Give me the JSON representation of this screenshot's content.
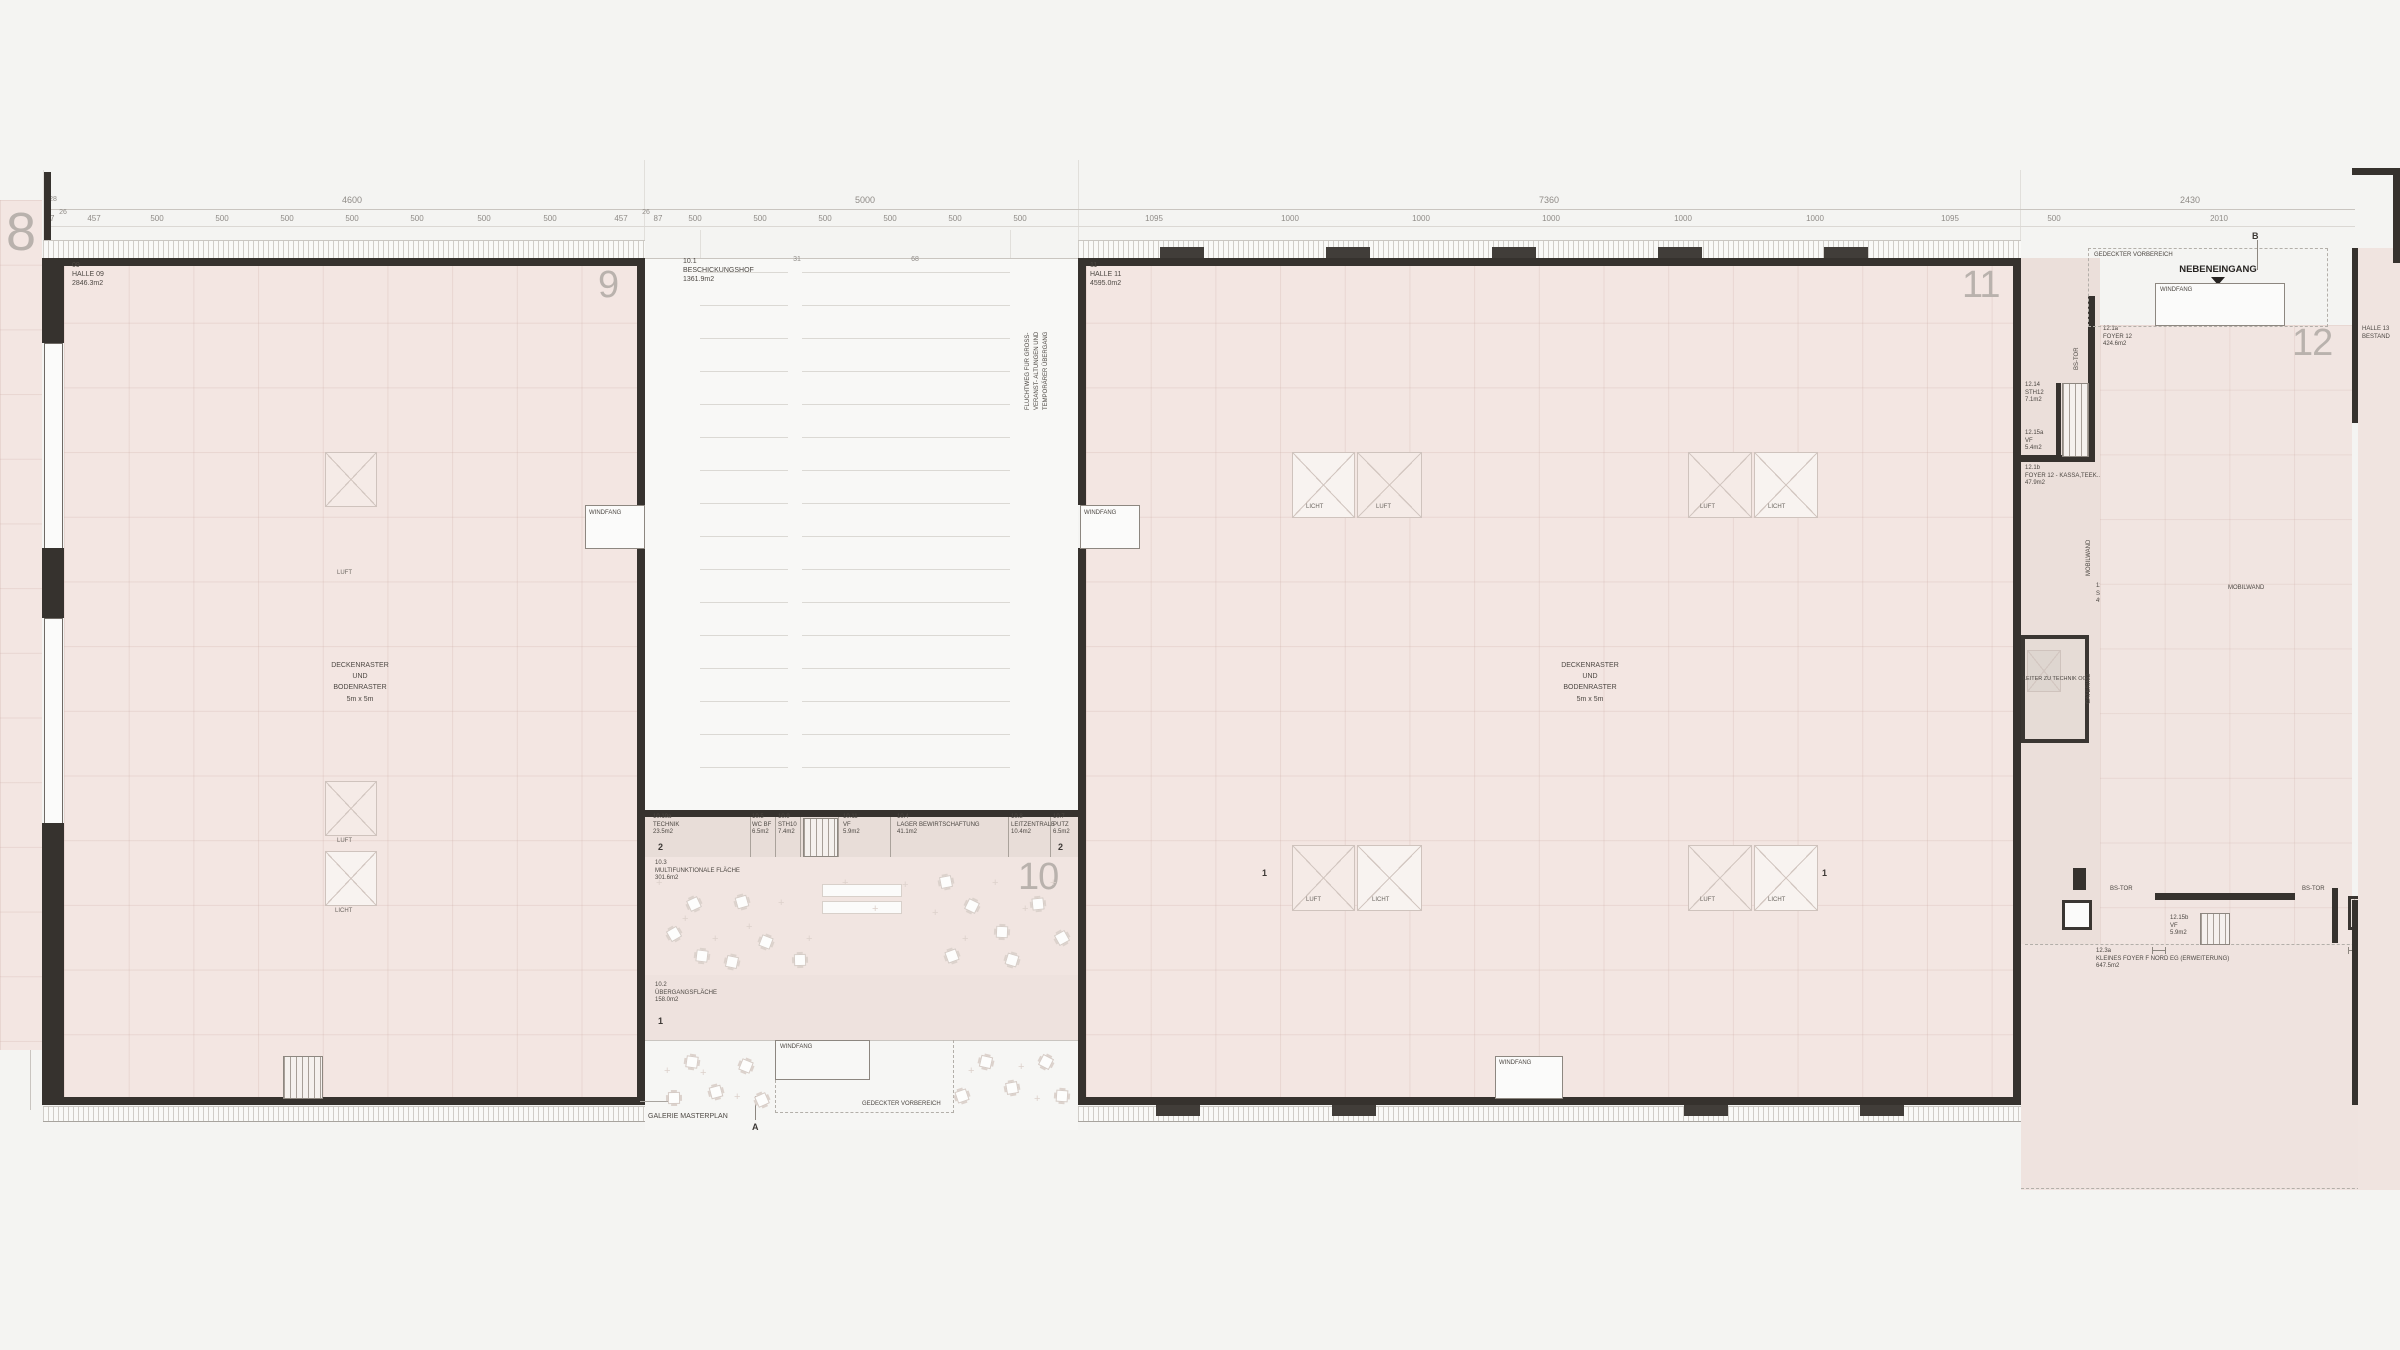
{
  "halls": {
    "h8": {
      "number": "8"
    },
    "h9": {
      "number": "9",
      "code": "09",
      "name": "HALLE 09",
      "area": "2846.3m2"
    },
    "h10": {
      "number": "10"
    },
    "h11": {
      "number": "11",
      "code": "11",
      "name": "HALLE 11",
      "area": "4595.0m2"
    },
    "h12": {
      "number": "12"
    },
    "h13": {
      "name": "HALLE 13",
      "status": "BESTAND"
    }
  },
  "rooms": {
    "r10_1": {
      "code": "10.1",
      "name": "BESCHICKUNGSHOF",
      "area": "1361.9m2"
    },
    "r10_10a": {
      "code": "10.10a",
      "name": "TECHNIK",
      "area": "23.5m2"
    },
    "r10_5": {
      "code": "10.5",
      "name": "WC  BF",
      "area": "6.5m2"
    },
    "r10_9": {
      "code": "10.9",
      "name": "STH10",
      "area": "7.4m2"
    },
    "r10_11": {
      "code": "10.11",
      "name": "VF",
      "area": "5.9m2"
    },
    "r10_4": {
      "code": "10.4",
      "name": "LAGER BEWIRTSCHAFTUNG",
      "area": "41.1m2"
    },
    "r10_8": {
      "code": "10.8",
      "name": "LEITZENTRALE",
      "area": "10.4m2"
    },
    "r10_7": {
      "code": "10.7",
      "name": "PUTZ",
      "area": "6.5m2"
    },
    "r10_3": {
      "code": "10.3",
      "name": "MULTIFUNKTIONALE FLÄCHE",
      "area": "301.6m2"
    },
    "r10_2": {
      "code": "10.2",
      "name": "ÜBERGANGSFLÄCHE",
      "area": "158.0m2"
    },
    "r12_14": {
      "code": "12.14",
      "name": "STH12",
      "area": "7.1m2"
    },
    "r12_15a": {
      "code": "12.15a",
      "name": "VF",
      "area": "5.4m2"
    },
    "r12_1b": {
      "code": "12.1b",
      "name": "FOYER 12 - KASSA,TEEK...",
      "area": "47.9m2"
    },
    "r12_1a": {
      "code": "12.1a",
      "name": "FOYER 12",
      "area": "424.6m2"
    },
    "r12_2": {
      "code": "12.2",
      "name": "SAAL 12",
      "area": "498.5m2"
    },
    "r12_15b": {
      "code": "12.15b",
      "name": "VF",
      "area": "5.9m2"
    },
    "r10_10b": {
      "code": "10.10b",
      "name": "TECHNIK HALLE 12",
      "area": "102.2m2"
    },
    "r12_3a": {
      "code": "12.3a",
      "name": "KLEINES FOYER F NORD EG (ERWEITERUNG)",
      "area": "647.5m2"
    }
  },
  "labels": {
    "windfang": "WINDFANG",
    "gedeckter_vorbereich": "GEDECKTER VORBEREICH",
    "nebeneingang": "NEBENEINGANG",
    "galerie_masterplan": "GALERIE MASTERPLAN",
    "raster_l1": "DECKENRASTER",
    "raster_l2": "UND",
    "raster_l3": "BODENRASTER",
    "raster_l4": "5m x 5m",
    "fluchtweg_l1": "FLUCHTWEG FÜR GROSS-",
    "fluchtweg_l2": "VERANST- ALTUNGEN UND",
    "fluchtweg_l3": "TEMPORÄRER ÜBERGANG",
    "luft": "LUFT",
    "licht": "LICHT",
    "mobilwand": "MOBILWAND",
    "catering": "CATERING",
    "leiter": "LEITER ZU TECHNIK OG",
    "bs_tor": "BS-TOR",
    "lift_l1": "LIFT",
    "lift_l2": "VAR",
    "ffok_l1": "FFOK=",
    "ffok_l2": "0.00m",
    "grid_a": "31",
    "grid_b": "68"
  },
  "sections": {
    "s1": "1",
    "s2": "2",
    "sa": "A",
    "sb": "B"
  },
  "dims": {
    "top_big": [
      "4600",
      "5000",
      "7360",
      "2430"
    ],
    "h9": [
      "67",
      "26",
      "457",
      "500",
      "500",
      "500",
      "500",
      "500",
      "500",
      "500",
      "457",
      "26",
      "87"
    ],
    "court": [
      "500",
      "500",
      "500",
      "500",
      "500",
      "500"
    ],
    "h11": [
      "1095",
      "1000",
      "1000",
      "1000",
      "1000",
      "1000",
      "1095",
      "500"
    ],
    "right_sub": "2010",
    "left": [
      "80",
      "970",
      "1000",
      "1000",
      "500"
    ],
    "left_big": "6600",
    "top_small": "28"
  },
  "colors": {
    "hall_fill": "#f3e6e2",
    "wall": "#36322e",
    "background": "#f4f4f2",
    "service_fill": "#e8ddd8",
    "big_number": "#b9b2ad"
  }
}
